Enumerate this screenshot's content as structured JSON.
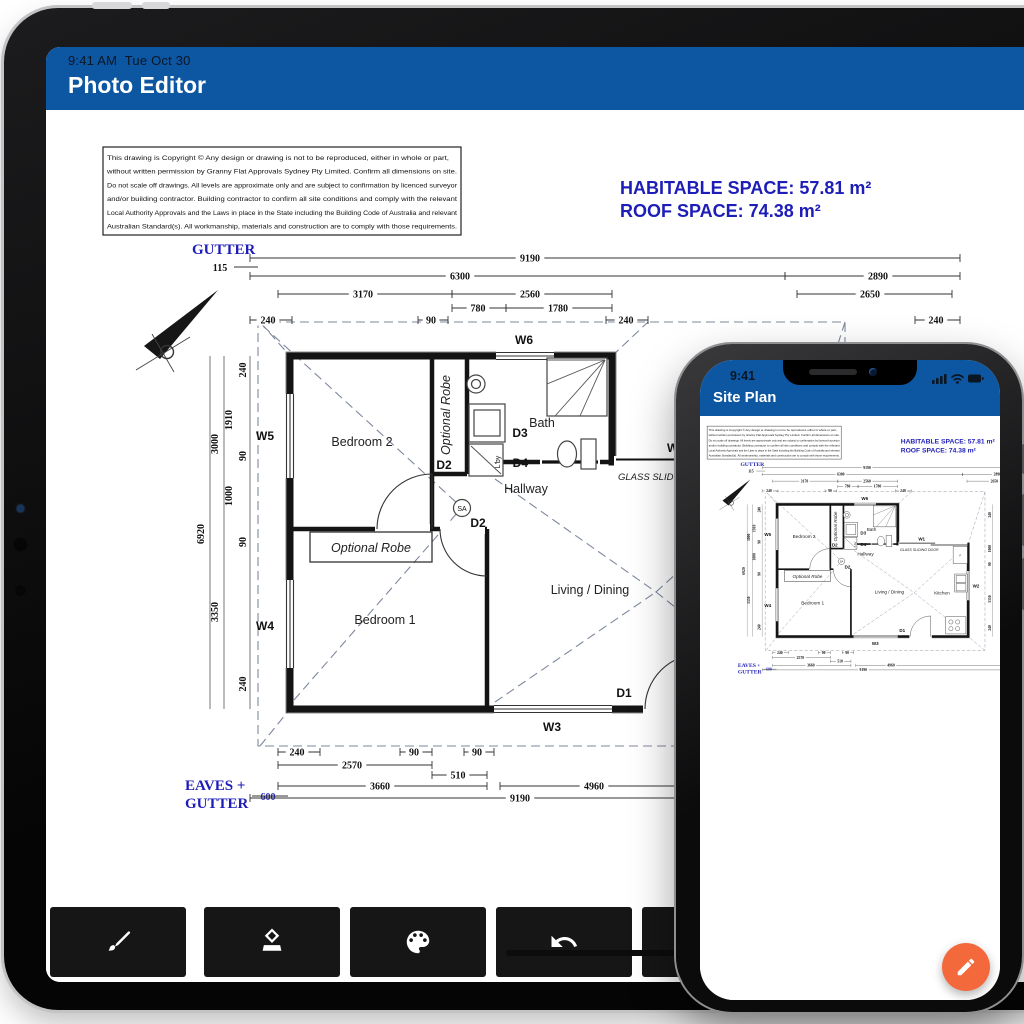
{
  "colors": {
    "header_blue": "#0d57a2",
    "annotation_blue": "#1d1db8",
    "fab_orange": "#f4693c",
    "toolbar_button": "#161616",
    "status_text": "#0b1624"
  },
  "tablet": {
    "status_time": "9:41 AM",
    "status_date": "Tue Oct 30",
    "title": "Photo Editor",
    "toolbar_buttons": [
      "brush",
      "eraser",
      "palette",
      "undo",
      "more"
    ]
  },
  "phone": {
    "status_time": "9:41",
    "title": "Site Plan",
    "fab_icon": "pencil"
  },
  "plan": {
    "disclaimer": [
      "This drawing is Copyright © Any design or drawing is not to be reproduced, either in whole or part,",
      "without written permission by Granny Flat Approvals Sydney Pty Limited. Confirm all dimensions on site.",
      "Do not scale off drawings. All levels are approximate only and are subject to confirmation by licenced surveyor",
      "and/or building contractor. Building contractor to confirm all site conditions and comply with the relevant",
      "Local Authority Approvals and the Laws in place in the State including the Building Code of Australia and relevant",
      "Australian Standard(s). All workmanship, materials and construction are to comply with those requirements."
    ],
    "habitable_space": "HABITABLE SPACE: 57.81 m²",
    "roof_space": "ROOF SPACE: 74.38 m²",
    "labels": {
      "gutter": "GUTTER",
      "gutter_offset": "115",
      "eaves_line1": "EAVES +",
      "eaves_line2": "GUTTER",
      "eaves_offset": "600",
      "glass_sliding_door": "GLASS SLIDING DOOR",
      "smoke_alarm": "SA",
      "fridge": "F",
      "laundry": "L'by"
    },
    "rooms": {
      "bedroom2": "Bedroom 2",
      "bedroom1": "Bedroom 1",
      "living": "Living / Dining",
      "kitchen": "Kitchen",
      "bath": "Bath",
      "hallway": "Hallway",
      "robe_vertical": "Optional Robe",
      "robe_horizontal": "Optional Robe"
    },
    "windows": {
      "w1": "W1",
      "w2": "W2",
      "w3": "W3",
      "w4": "W4",
      "w5": "W5",
      "w6": "W6"
    },
    "doors": {
      "d1": "D1",
      "d2a": "D2",
      "d2b": "D2",
      "d3": "D3",
      "d4": "D4"
    },
    "dims": {
      "top": [
        "9190",
        "6300",
        "2890",
        "3170",
        "2560",
        "2650",
        "780",
        "1780",
        "240",
        "90",
        "240",
        "240"
      ],
      "left": [
        "240",
        "1910",
        "3000",
        "90",
        "1000",
        "6920",
        "90",
        "3350",
        "240"
      ],
      "bottom": [
        "240",
        "90",
        "90",
        "2570",
        "510",
        "3660",
        "4960",
        "9190",
        "240"
      ],
      "right": [
        "240",
        "1000",
        "90",
        "3350",
        "240"
      ]
    }
  }
}
